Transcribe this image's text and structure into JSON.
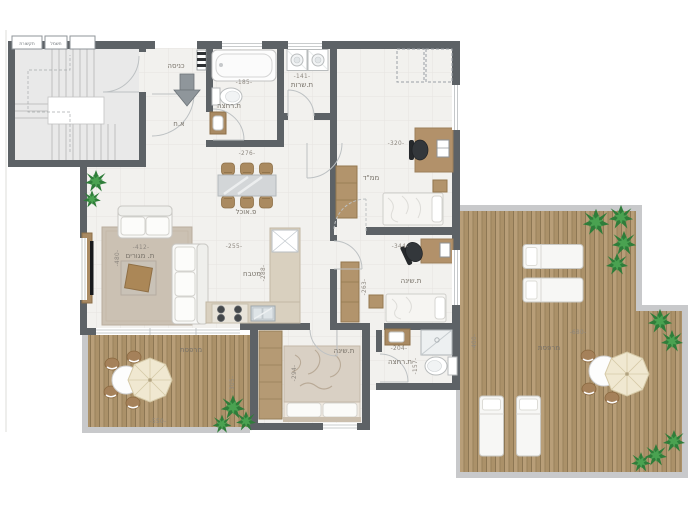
{
  "plan_type": "apartment floor plan",
  "colors": {
    "wall": "#5d6266",
    "floor": "#f2f1ee",
    "deck_plank": "#b29872",
    "parapet": "#c8c9cb",
    "wood_furniture": "#ab8a60",
    "rug": "#cbc1b3",
    "counter": "#d9d0bf",
    "plant": "#2f7d3a",
    "umbrella": "#f0e8d1"
  },
  "annotations": {
    "comm_closet": "תקשורת",
    "electric_closet": "חשמל",
    "entry_note": "א.ח"
  },
  "rooms": [
    {
      "id": "entrance",
      "label": "כניסה"
    },
    {
      "id": "living",
      "label": "ת. מגורים",
      "dim_w": "-412-",
      "dim_d": "-480-"
    },
    {
      "id": "dining",
      "label": "פ.אוכל",
      "dim_w": "-276-"
    },
    {
      "id": "kitchen",
      "label": "מטבח",
      "dim_w": "-255-",
      "dim_d": "-288-"
    },
    {
      "id": "bath-main",
      "label": "ת.רחצה",
      "dim_w": "-185-"
    },
    {
      "id": "wc",
      "label": "ת.שרות",
      "dim_w": "-141-"
    },
    {
      "id": "mamad",
      "label": "ממ\"ד",
      "dim_w": "-320-"
    },
    {
      "id": "bedroom-mid",
      "label": "ת.שינה",
      "dim_w": "-344-",
      "dim_d": "-263-"
    },
    {
      "id": "bedroom-back",
      "label": "ת.שינה",
      "dim_d": "-294-"
    },
    {
      "id": "bath-back",
      "label": "ת.רחצה",
      "dim_w": "-204-",
      "dim_d": "-157-"
    },
    {
      "id": "terrace-left",
      "label": "מרפסת",
      "dim_w": "-550-",
      "dim_d": "-305-"
    },
    {
      "id": "terrace-right",
      "label": "מרפסת",
      "dim_w": "-680-",
      "dim_d": "-400-"
    }
  ]
}
